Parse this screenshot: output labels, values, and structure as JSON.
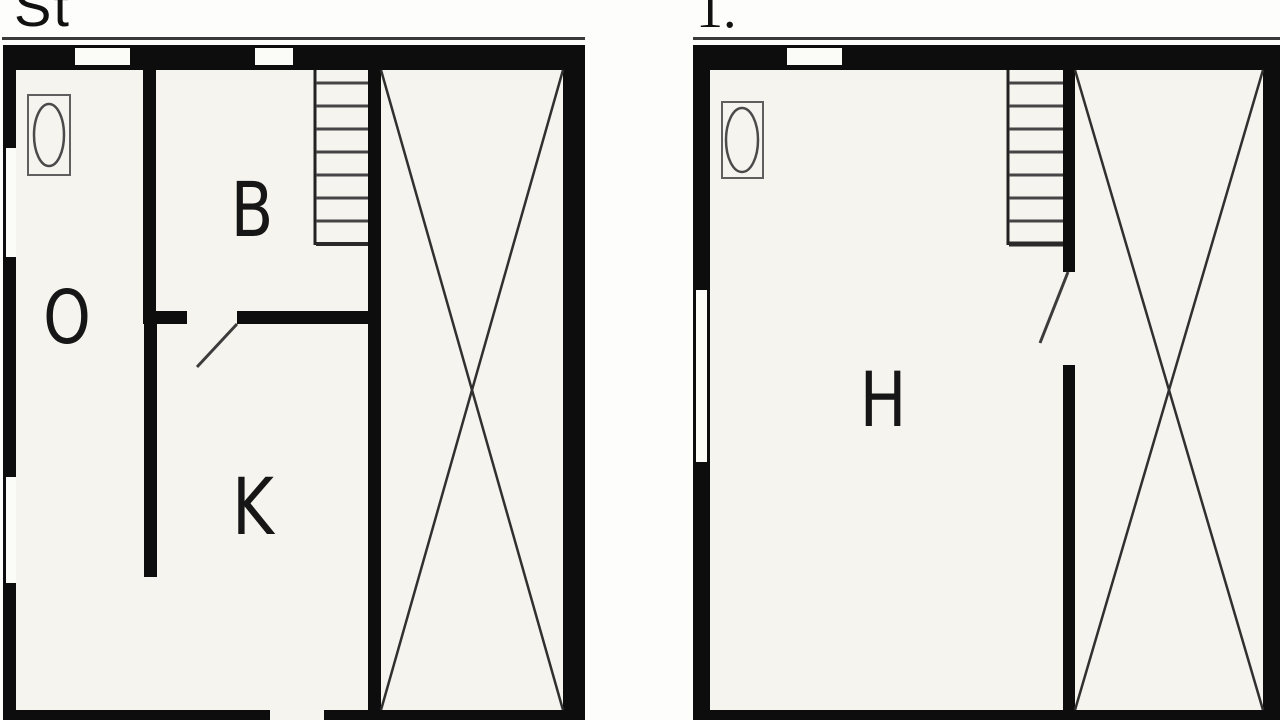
{
  "colors": {
    "page_background": "#fdfdfc",
    "floor_background": "#f5f4ee",
    "wall": "#0d0d0d",
    "diagonal_line": "#303030",
    "stair_tread": "#454545",
    "fixture_stroke": "#5f5f5f",
    "door_swing": "#3c3c3c"
  },
  "left_plan": {
    "title": "St",
    "room_o_label": "O",
    "room_b_label": "B",
    "room_k_label": "K",
    "features": {
      "staircase": "staircase",
      "void_area": "crossed-void-area",
      "fixture": "toilet-fixture"
    }
  },
  "right_plan": {
    "title": "1.",
    "room_h_label": "H",
    "features": {
      "staircase": "staircase",
      "void_area": "crossed-void-area",
      "fixture": "toilet-fixture"
    }
  }
}
